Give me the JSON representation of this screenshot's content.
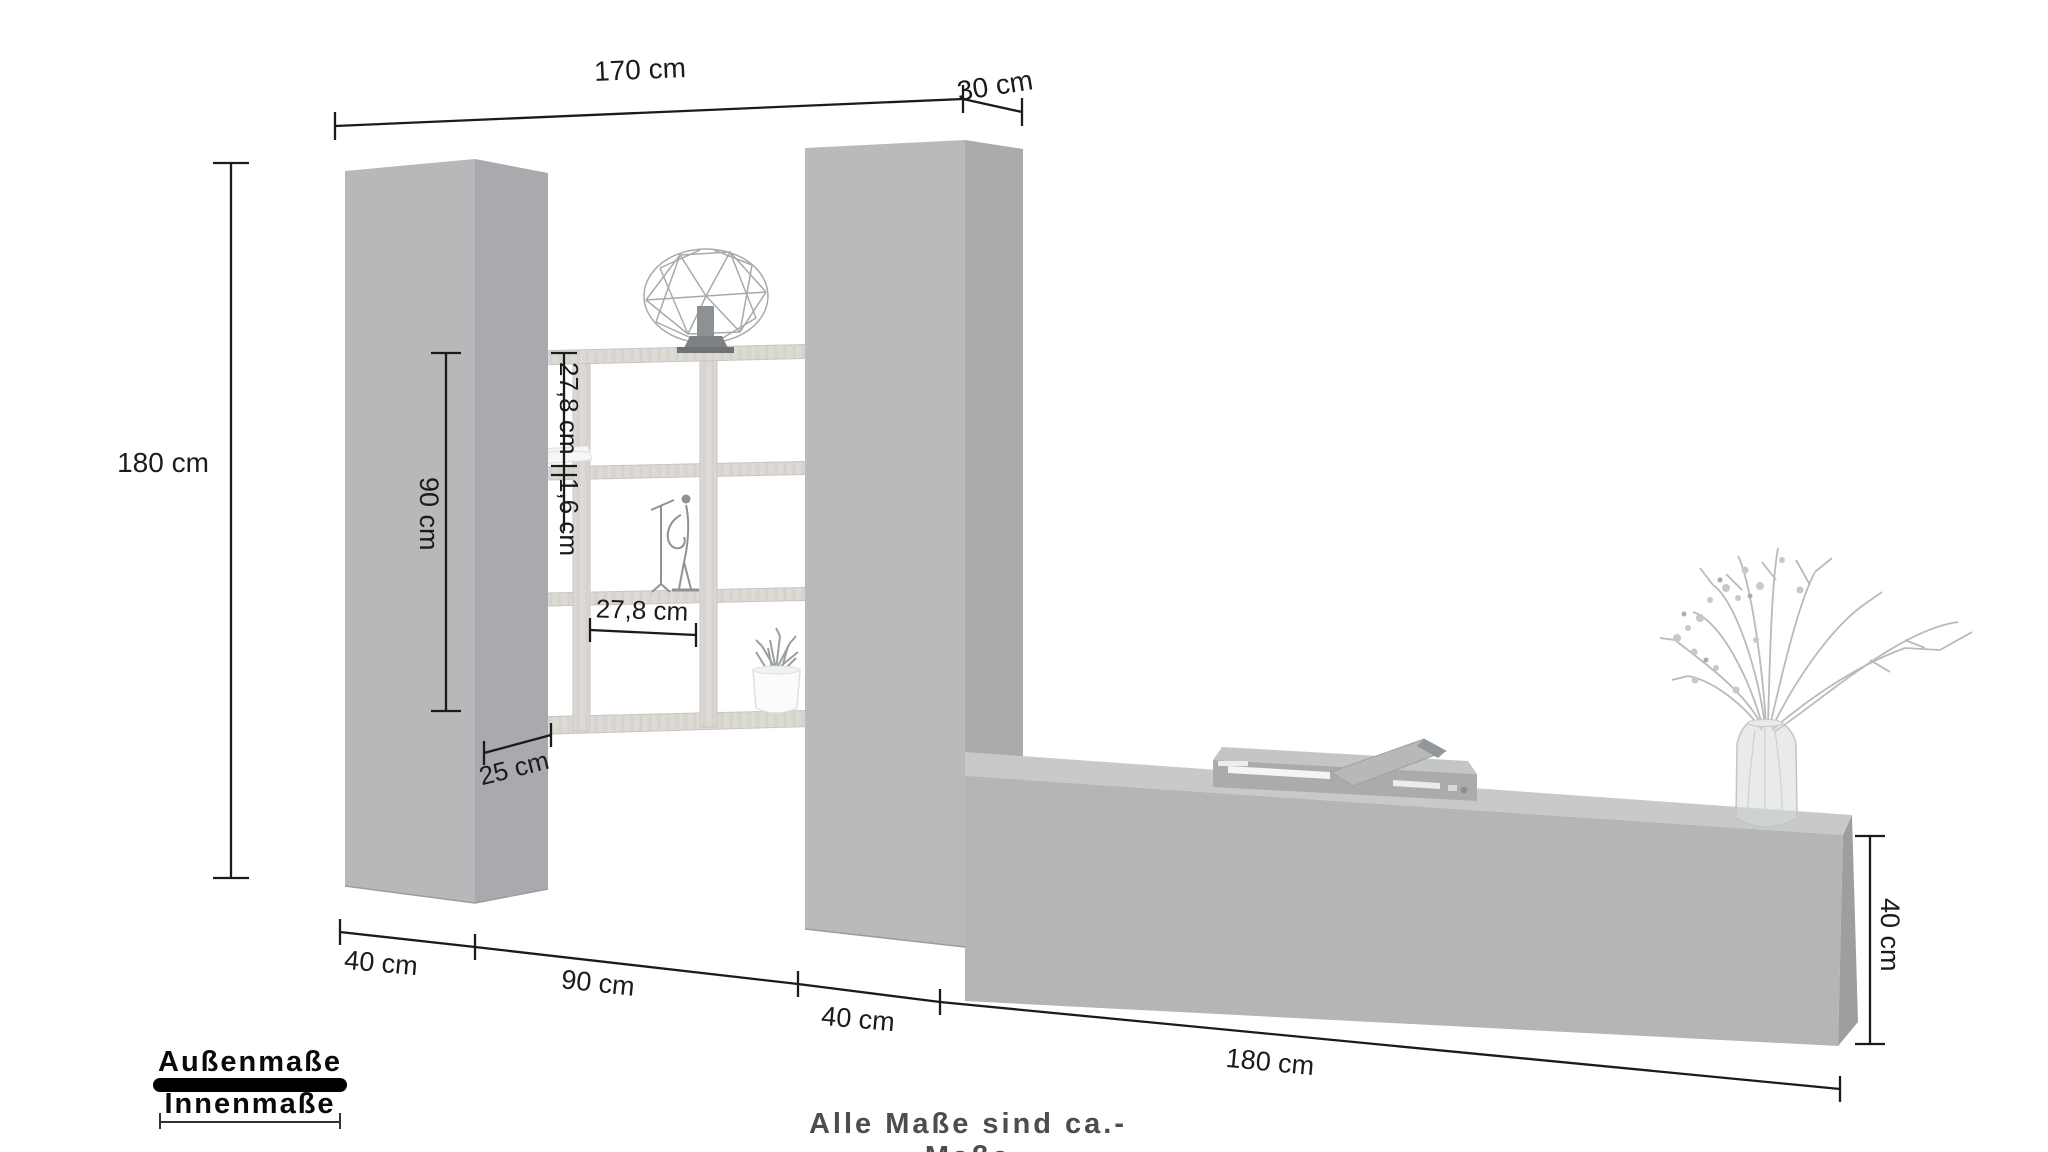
{
  "dimensions": {
    "top_width": "170 cm",
    "top_depth": "30 cm",
    "total_height": "180 cm",
    "shelf_height": "90 cm",
    "shelf_cell_height": "27,8 cm",
    "shelf_board_thickness": "1,6 cm",
    "shelf_cell_width": "27,8 cm",
    "shelf_depth": "25 cm",
    "left_cabinet_width": "40 cm",
    "shelf_width": "90 cm",
    "right_cabinet_width": "40 cm",
    "lowboard_width": "180 cm",
    "lowboard_height": "40 cm"
  },
  "legend": {
    "outer_label": "Außenmaße",
    "inner_label": "Innenmaße"
  },
  "footer": {
    "note": "Alle Maße sind ca.-Maße"
  },
  "colors": {
    "background": "#ffffff",
    "cabinet_front": "#b6b8ba",
    "cabinet_side": "#a8aaad",
    "lowboard_top": "#c7c9cb",
    "lowboard_front": "#b3b5b7",
    "lowboard_side": "#9c9ea0",
    "shelf_wood": "#dbd8d4",
    "dimension_line": "#1b1b1b",
    "legend_outer_line": "#000000",
    "legend_inner_line": "#333333",
    "footer_text": "#4d4d4d"
  }
}
